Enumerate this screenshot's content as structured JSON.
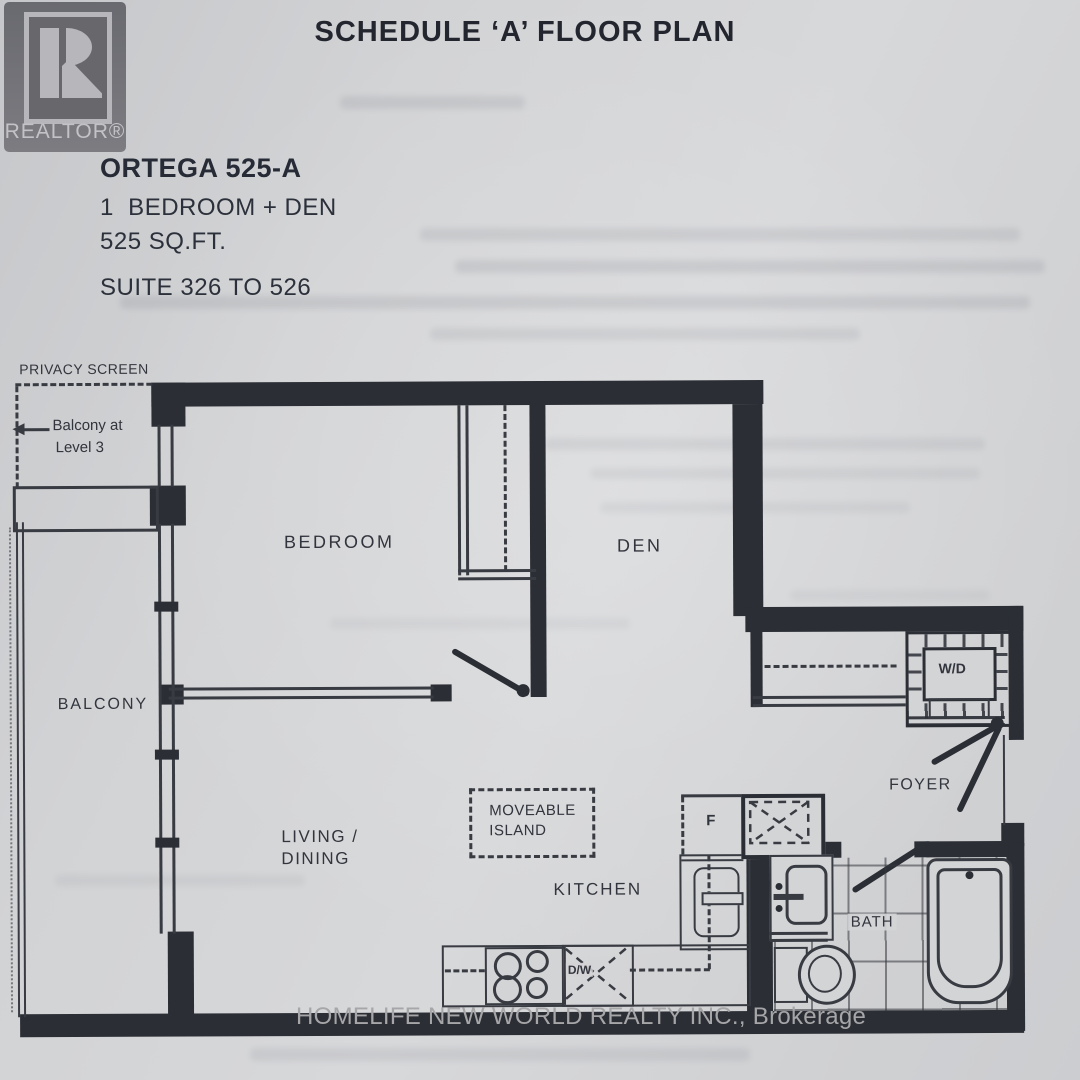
{
  "page": {
    "title": "SCHEDULE ‘A’ FLOOR PLAN",
    "watermark": "HOMELIFE NEW WORLD REALTY INC., Brokerage"
  },
  "logo": {
    "letter": "R",
    "wordmark": "REALTOR®"
  },
  "unit_info": {
    "model": "ORTEGA 525-A",
    "layout": "1  BEDROOM + DEN",
    "area": "525 SQ.FT.",
    "suites": "SUITE 326 TO 526"
  },
  "rooms": {
    "bedroom": "BEDROOM",
    "den": "DEN",
    "balcony": "BALCONY",
    "living_line1": "LIVING /",
    "living_line2": "DINING",
    "kitchen": "KITCHEN",
    "foyer": "FOYER",
    "bath": "BATH"
  },
  "annotations": {
    "privacy_screen": "PRIVACY SCREEN",
    "balcony_level_line1": "Balcony at",
    "balcony_level_line2": "Level 3",
    "island_line1": "MOVEABLE",
    "island_line2": "ISLAND",
    "washer_dryer": "W/D",
    "fridge": "F",
    "dishwasher": "D/W"
  },
  "colors": {
    "wall": "#2b2e35",
    "line": "#383b42",
    "ink": "#262b36",
    "paper": "#d3d4d6",
    "watermark": "#a6a6a8",
    "logo_gray": "#6f6f74"
  }
}
